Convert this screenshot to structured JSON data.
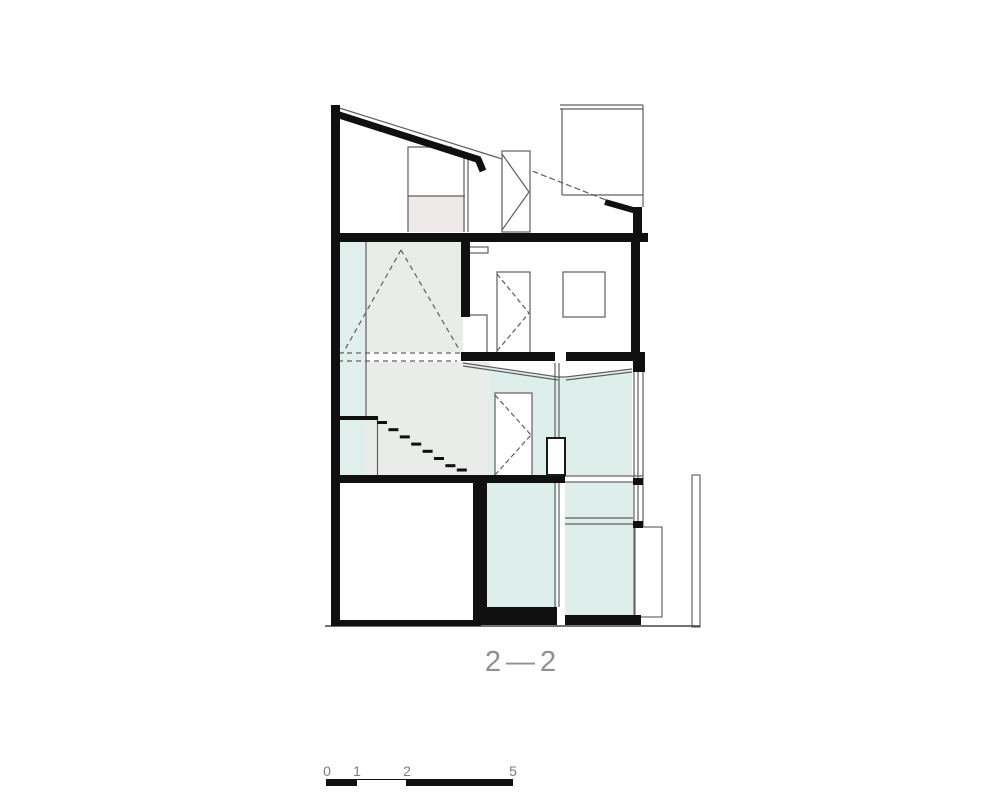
{
  "drawing": {
    "type": "architectural-section",
    "section_label": "2—2",
    "scale_bar": {
      "labels": [
        "0",
        "1",
        "2",
        "5"
      ]
    },
    "colors": {
      "wall_cut": "#101010",
      "thin_line": "#5f5f5f",
      "glass_fill": "#deeeeb",
      "hall_fill": "#e9ece8",
      "closet_fill": "#edeae9",
      "label_gray": "#8f8f8f"
    },
    "legend": {
      "glass_regions": "light cyan tinted glazing",
      "stair": "dashed tread marks descending left to right"
    }
  }
}
